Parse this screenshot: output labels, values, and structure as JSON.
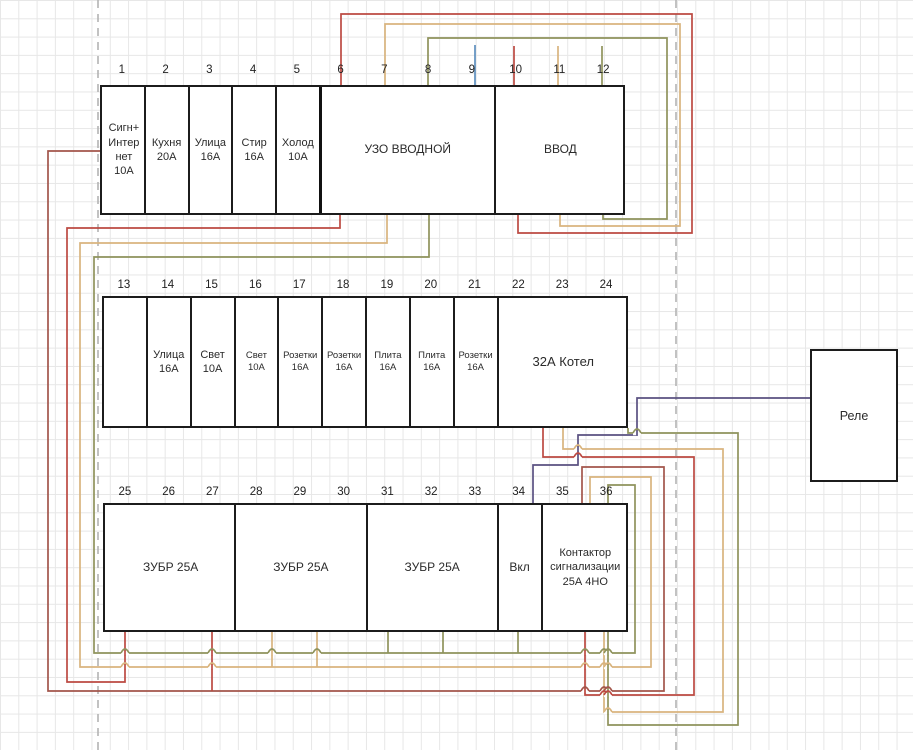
{
  "diagram_title": "Electrical panel wiring diagram",
  "colors": {
    "red": "#bc4a42",
    "darkred": "#a3564b",
    "tan": "#d9b47e",
    "olive": "#8f935c",
    "blue": "#5e8fbe",
    "purple": "#5a5181",
    "box_border": "#1c1c1c",
    "grid": "#e7e7e7",
    "dashed": "#b3b3b3"
  },
  "rows": [
    {
      "name": "top-row",
      "left": 100,
      "top": 85,
      "width": 525,
      "height": 130,
      "number_top": 64,
      "numbers": [
        "1",
        "2",
        "3",
        "4",
        "5",
        "6",
        "7",
        "8",
        "9",
        "10",
        "11",
        "12"
      ],
      "slot_w": 43.75,
      "boxes": [
        {
          "name": "breaker-sign-internet",
          "left": 0,
          "width": 43.75,
          "font": 11,
          "lines": [
            "Сигн+",
            "Интер",
            "нет",
            "10А"
          ]
        },
        {
          "name": "breaker-kitchen",
          "left": 43.75,
          "width": 43.75,
          "font": 11,
          "lines": [
            "Кухня",
            "20А"
          ]
        },
        {
          "name": "breaker-street",
          "left": 87.5,
          "width": 43.75,
          "font": 11,
          "lines": [
            "Улица",
            "16А"
          ]
        },
        {
          "name": "breaker-washer",
          "left": 131.25,
          "width": 43.75,
          "font": 11,
          "lines": [
            "Стир",
            "16А"
          ]
        },
        {
          "name": "breaker-fridge",
          "left": 175,
          "width": 43.75,
          "font": 11,
          "lines": [
            "Холод",
            "10А"
          ]
        },
        {
          "name": "uzo-main",
          "left": 218.75,
          "width": 175,
          "font": 12,
          "lines": [
            "УЗО ВВОДНОЙ"
          ],
          "thick": true
        },
        {
          "name": "input-main",
          "left": 393.75,
          "width": 131.25,
          "font": 12,
          "lines": [
            "ВВОД"
          ]
        }
      ]
    },
    {
      "name": "middle-row",
      "left": 102,
      "top": 296,
      "width": 526,
      "height": 132,
      "number_top": 279,
      "numbers": [
        "13",
        "14",
        "15",
        "16",
        "17",
        "18",
        "19",
        "20",
        "21",
        "22",
        "23",
        "24"
      ],
      "slot_w": 43.83,
      "boxes": [
        {
          "name": "module-13-empty",
          "left": 0,
          "width": 43.83,
          "font": 11,
          "lines": []
        },
        {
          "name": "breaker-street-2",
          "left": 43.83,
          "width": 43.83,
          "font": 11,
          "lines": [
            "Улица",
            "16А"
          ]
        },
        {
          "name": "breaker-light-1",
          "left": 87.67,
          "width": 43.83,
          "font": 11,
          "lines": [
            "Свет",
            "10А"
          ]
        },
        {
          "name": "breaker-light-2",
          "left": 131.5,
          "width": 43.83,
          "font": 9.5,
          "lines": [
            "Свет",
            "10А"
          ]
        },
        {
          "name": "breaker-sockets-1",
          "left": 175.33,
          "width": 43.83,
          "font": 9.5,
          "lines": [
            "Розетки",
            "16А"
          ]
        },
        {
          "name": "breaker-sockets-2",
          "left": 219.17,
          "width": 43.83,
          "font": 9.5,
          "lines": [
            "Розетки",
            "16А"
          ]
        },
        {
          "name": "breaker-stove-1",
          "left": 263,
          "width": 43.83,
          "font": 9.5,
          "lines": [
            "Плита",
            "16А"
          ]
        },
        {
          "name": "breaker-stove-2",
          "left": 306.83,
          "width": 43.83,
          "font": 9.5,
          "lines": [
            "Плита",
            "16А"
          ]
        },
        {
          "name": "breaker-sockets-3",
          "left": 350.67,
          "width": 43.83,
          "font": 9.5,
          "lines": [
            "Розетки",
            "16А"
          ]
        },
        {
          "name": "breaker-boiler",
          "left": 394.5,
          "width": 131.5,
          "font": 13,
          "lines": [
            "32А Котел"
          ]
        }
      ]
    },
    {
      "name": "bottom-row",
      "left": 103,
      "top": 503,
      "width": 525,
      "height": 129,
      "number_top": 486,
      "numbers": [
        "25",
        "26",
        "27",
        "28",
        "29",
        "30",
        "31",
        "32",
        "33",
        "34",
        "35",
        "36"
      ],
      "slot_w": 43.75,
      "boxes": [
        {
          "name": "zubr-1",
          "left": 0,
          "width": 131.25,
          "font": 12,
          "lines": [
            "ЗУБР 25А"
          ]
        },
        {
          "name": "zubr-2",
          "left": 131.25,
          "width": 131.25,
          "font": 12,
          "lines": [
            "ЗУБР 25А"
          ]
        },
        {
          "name": "zubr-3",
          "left": 262.5,
          "width": 131.25,
          "font": 12,
          "lines": [
            "ЗУБР 25А"
          ]
        },
        {
          "name": "switch-vkl",
          "left": 393.75,
          "width": 43.75,
          "font": 12,
          "lines": [
            "Вкл"
          ]
        },
        {
          "name": "contactor-alarm",
          "left": 437.5,
          "width": 87.5,
          "font": 11,
          "lines": [
            "Контактор",
            "сигнализации",
            "25А 4НО"
          ]
        }
      ]
    }
  ],
  "relay": {
    "label": "Реле",
    "left": 810,
    "top": 349,
    "width": 88,
    "height": 133
  },
  "dashed_lines_x": [
    98,
    676
  ],
  "wires": [
    {
      "name": "supply-stub-blue",
      "color": "blue",
      "points": [
        [
          475,
          45
        ],
        [
          475,
          85
        ]
      ]
    },
    {
      "name": "supply-stub-red",
      "color": "red",
      "points": [
        [
          514,
          46
        ],
        [
          514,
          85
        ]
      ]
    },
    {
      "name": "supply-stub-tan",
      "color": "tan",
      "points": [
        [
          558,
          46
        ],
        [
          558,
          85
        ]
      ]
    },
    {
      "name": "supply-stub-olive",
      "color": "olive",
      "points": [
        [
          602,
          46
        ],
        [
          602,
          85
        ]
      ]
    },
    {
      "name": "vvod-to-uzo-red",
      "color": "red",
      "points": [
        [
          518,
          215
        ],
        [
          518,
          233
        ],
        [
          692,
          233
        ],
        [
          692,
          14
        ],
        [
          341,
          14
        ],
        [
          341,
          85
        ]
      ]
    },
    {
      "name": "vvod-to-uzo-tan",
      "color": "tan",
      "points": [
        [
          560,
          215
        ],
        [
          560,
          226
        ],
        [
          680,
          226
        ],
        [
          680,
          24
        ],
        [
          385,
          24
        ],
        [
          385,
          85
        ]
      ]
    },
    {
      "name": "vvod-to-uzo-olive",
      "color": "olive",
      "points": [
        [
          603,
          215
        ],
        [
          603,
          219
        ],
        [
          667,
          219
        ],
        [
          667,
          38
        ],
        [
          428,
          38
        ],
        [
          428,
          85
        ]
      ]
    },
    {
      "name": "uzo-bus-red",
      "color": "red",
      "points": [
        [
          340,
          215
        ],
        [
          340,
          228
        ],
        [
          67,
          228
        ],
        [
          67,
          682
        ],
        [
          125,
          682
        ],
        [
          125,
          632
        ]
      ]
    },
    {
      "name": "uzo-bus-tan",
      "color": "tan",
      "points": [
        [
          387,
          215
        ],
        [
          387,
          243
        ],
        [
          80,
          243
        ],
        [
          80,
          667
        ],
        [
          651,
          667
        ],
        [
          651,
          477
        ],
        [
          590,
          477
        ],
        [
          590,
          503
        ]
      ]
    },
    {
      "name": "uzo-bus-olive",
      "color": "olive",
      "points": [
        [
          429,
          215
        ],
        [
          429,
          257
        ],
        [
          94,
          257
        ],
        [
          94,
          653
        ],
        [
          635,
          653
        ],
        [
          635,
          485
        ],
        [
          608,
          485
        ],
        [
          608,
          503
        ]
      ]
    },
    {
      "name": "sign-to-contactor",
      "color": "darkred",
      "points": [
        [
          100,
          151
        ],
        [
          48,
          151
        ],
        [
          48,
          691
        ],
        [
          664,
          691
        ],
        [
          664,
          467
        ],
        [
          582,
          467
        ],
        [
          582,
          503
        ]
      ]
    },
    {
      "name": "boiler-contactor-red",
      "color": "red",
      "points": [
        [
          543,
          428
        ],
        [
          543,
          457
        ],
        [
          694,
          457
        ],
        [
          694,
          695
        ],
        [
          585,
          695
        ],
        [
          585,
          632
        ]
      ]
    },
    {
      "name": "boiler-contactor-tan",
      "color": "tan",
      "points": [
        [
          563,
          428
        ],
        [
          563,
          449
        ],
        [
          723,
          449
        ],
        [
          723,
          712
        ],
        [
          604,
          712
        ],
        [
          604,
          632
        ]
      ]
    },
    {
      "name": "boiler-contactor-olive",
      "color": "olive",
      "points": [
        [
          628,
          428
        ],
        [
          628,
          433
        ],
        [
          738,
          433
        ],
        [
          738,
          725
        ],
        [
          608,
          725
        ],
        [
          608,
          632
        ]
      ]
    },
    {
      "name": "vkl-to-relay-purple",
      "color": "purple",
      "points": [
        [
          533,
          503
        ],
        [
          533,
          465
        ],
        [
          578,
          465
        ],
        [
          578,
          435
        ],
        [
          637,
          435
        ],
        [
          637,
          398
        ],
        [
          810,
          398
        ]
      ]
    },
    {
      "name": "zubr1-stub",
      "color": "red",
      "points": [
        [
          212,
          632
        ],
        [
          212,
          691
        ]
      ]
    },
    {
      "name": "zubr2-stub-a",
      "color": "tan",
      "points": [
        [
          272,
          632
        ],
        [
          272,
          667
        ]
      ]
    },
    {
      "name": "zubr2-stub-b",
      "color": "tan",
      "points": [
        [
          317,
          632
        ],
        [
          317,
          667
        ]
      ]
    },
    {
      "name": "zubr3-stub-a",
      "color": "olive",
      "points": [
        [
          388,
          632
        ],
        [
          388,
          653
        ]
      ]
    },
    {
      "name": "zubr3-stub-b",
      "color": "olive",
      "points": [
        [
          443,
          632
        ],
        [
          443,
          653
        ]
      ]
    },
    {
      "name": "vkl-stub",
      "color": "olive",
      "points": [
        [
          518,
          632
        ],
        [
          518,
          653
        ]
      ]
    }
  ],
  "hops": [
    {
      "x": 125,
      "y": 653,
      "h": "olive",
      "v": "red"
    },
    {
      "x": 212,
      "y": 653,
      "h": "olive",
      "v": "red"
    },
    {
      "x": 272,
      "y": 653,
      "h": "olive",
      "v": "tan"
    },
    {
      "x": 317,
      "y": 653,
      "h": "olive",
      "v": "tan"
    },
    {
      "x": 585,
      "y": 653,
      "h": "olive",
      "v": "red"
    },
    {
      "x": 604,
      "y": 653,
      "h": "olive",
      "v": "tan"
    },
    {
      "x": 608,
      "y": 653,
      "h": "olive",
      "v": "olive"
    },
    {
      "x": 125,
      "y": 667,
      "h": "tan",
      "v": "red"
    },
    {
      "x": 212,
      "y": 667,
      "h": "tan",
      "v": "red"
    },
    {
      "x": 585,
      "y": 667,
      "h": "tan",
      "v": "red"
    },
    {
      "x": 604,
      "y": 667,
      "h": "tan",
      "v": "tan"
    },
    {
      "x": 608,
      "y": 667,
      "h": "tan",
      "v": "olive"
    },
    {
      "x": 585,
      "y": 691,
      "h": "darkred",
      "v": "red"
    },
    {
      "x": 604,
      "y": 691,
      "h": "darkred",
      "v": "tan"
    },
    {
      "x": 608,
      "y": 691,
      "h": "darkred",
      "v": "olive"
    },
    {
      "x": 604,
      "y": 695,
      "h": "red",
      "v": "tan"
    },
    {
      "x": 608,
      "y": 695,
      "h": "red",
      "v": "olive"
    },
    {
      "x": 608,
      "y": 712,
      "h": "tan",
      "v": "olive"
    },
    {
      "x": 578,
      "y": 457,
      "h": "red",
      "v": "purple"
    },
    {
      "x": 578,
      "y": 449,
      "h": "tan",
      "v": "purple"
    },
    {
      "x": 637,
      "y": 433,
      "h": "olive",
      "v": "purple"
    }
  ]
}
